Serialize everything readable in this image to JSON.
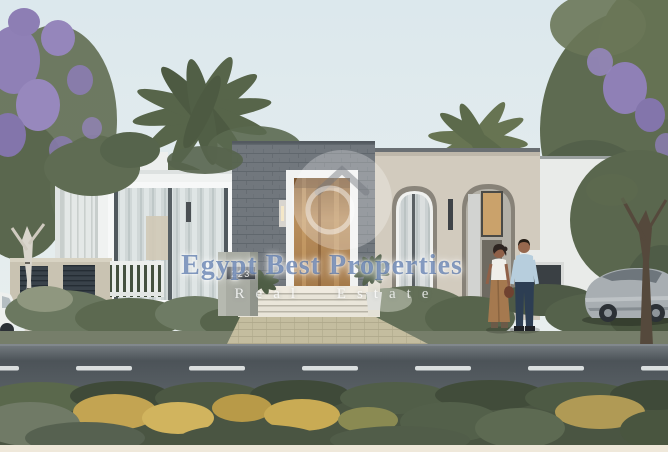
{
  "image": {
    "kind": "real-estate-architectural-rendering",
    "subject": "Modern single-storey villa with grey stone entrance, white and beige wings, arched windows, front garden hedges, tiled walkway, street with dashed lane line, a couple talking and a parked silver sports car"
  },
  "watermark": {
    "brand": "Egypt Best Properties",
    "tagline": "Real Estate",
    "logo_icon": "house-in-circle-icon",
    "brand_color": "#2f5496",
    "tagline_color": "#ffffff"
  },
  "villa": {
    "house_number": "223"
  },
  "palette": {
    "sky": "#dfeaee",
    "white_wall": "#f1f3f2",
    "stone_cladding": "#70767c",
    "beige_wall": "#d2cbbe",
    "door_wood": "#b98a58",
    "foliage_green": "#5d6a4f",
    "jacaranda_bloom": "#8f80b6",
    "hedge_yellow": "#c6a853",
    "walkway_tile": "#ccc5a7",
    "road_asphalt": "#51585e",
    "lane_dash": "#e6eaea",
    "car_silver": "#a8aeb2"
  }
}
